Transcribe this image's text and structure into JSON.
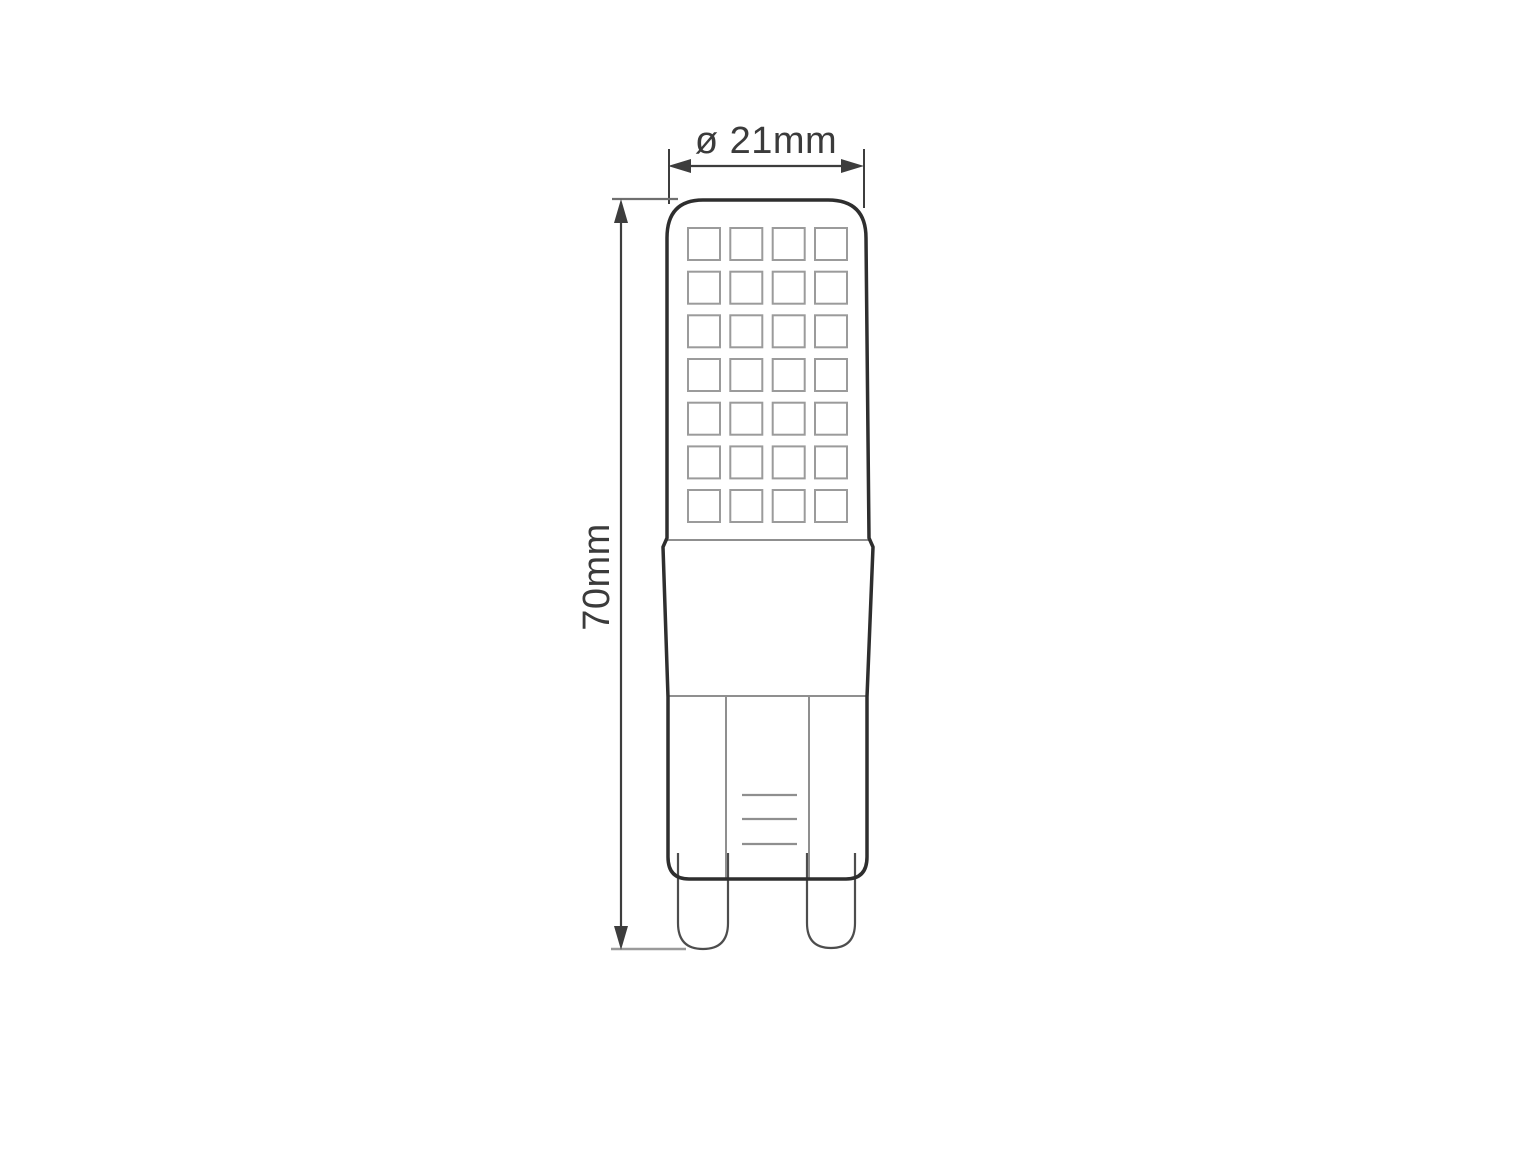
{
  "labels": {
    "diameter": "ø 21mm",
    "height": "70mm"
  },
  "values": {
    "diameter_mm": 21,
    "height_mm": 70
  },
  "led_grid": {
    "rows": 7,
    "columns": 4
  },
  "colors": {
    "background": "#ffffff",
    "outline": "#2e2e2e",
    "detail": "#8f8f8f",
    "grid": "#9b9b9b",
    "pin": "#4d4d4d",
    "dimension": "#3d3d3d",
    "tick_top": "#6f6f6f",
    "tick_bottom": "#9a9a9a",
    "text": "#3b3b3b"
  }
}
